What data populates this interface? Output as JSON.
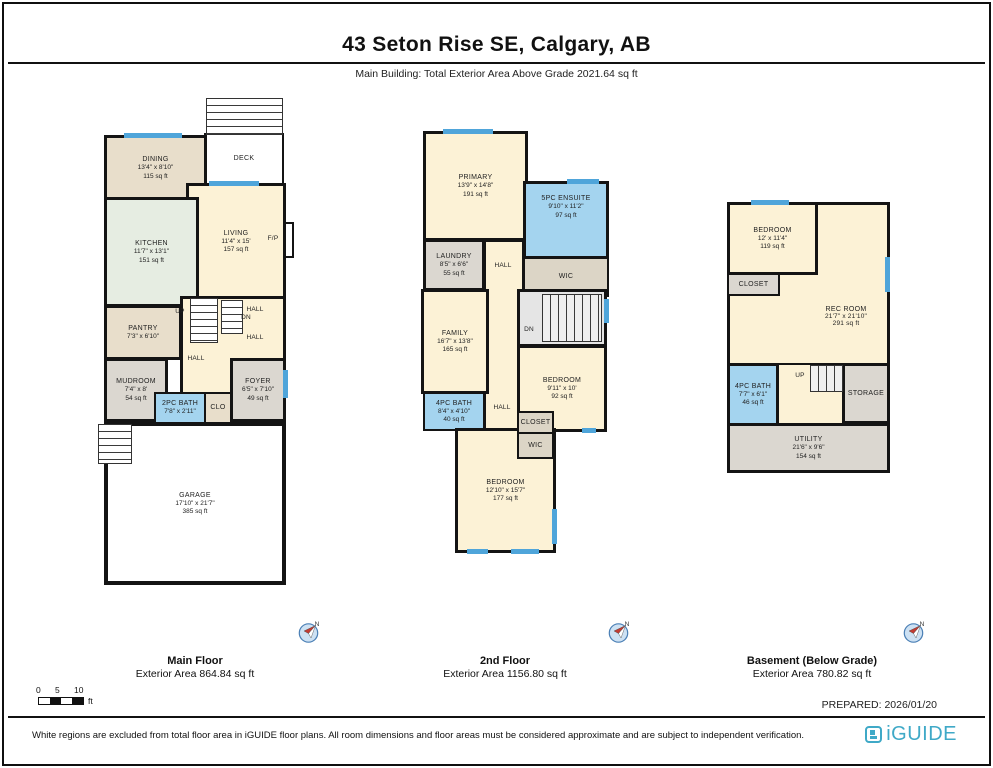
{
  "header": {
    "title": "43 Seton Rise SE, Calgary, AB",
    "subtitle": "Main Building: Total Exterior Area Above Grade 2021.64 sq ft"
  },
  "floors": [
    {
      "caption": "Main Floor",
      "area": "Exterior Area 864.84 sq ft",
      "rooms": {
        "deck": {
          "label": "DECK"
        },
        "dining": {
          "label": "DINING",
          "dims": "13'4\" x 8'10\"",
          "area": "115 sq ft"
        },
        "kitchen": {
          "label": "KITCHEN",
          "dims": "11'7\" x 13'1\"",
          "area": "151 sq ft"
        },
        "living": {
          "label": "LIVING",
          "dims": "11'4\" x 15'",
          "area": "157 sq ft"
        },
        "fp": {
          "label": "F/P"
        },
        "pantry": {
          "label": "PANTRY",
          "dims": "7'3\" x 6'10\""
        },
        "up": {
          "label": "UP"
        },
        "dn": {
          "label": "DN"
        },
        "hall_a": {
          "label": "HALL"
        },
        "hall_b": {
          "label": "HALL"
        },
        "hall": {
          "label": "HALL"
        },
        "mudroom": {
          "label": "MUDROOM",
          "dims": "7'4\" x 8'",
          "area": "54 sq ft"
        },
        "bath2": {
          "label": "2PC BATH",
          "dims": "7'8\" x 2'11\""
        },
        "clo": {
          "label": "CLO"
        },
        "foyer": {
          "label": "FOYER",
          "dims": "6'5\" x 7'10\"",
          "area": "49 sq ft"
        },
        "garage": {
          "label": "GARAGE",
          "dims": "17'10\" x 21'7\"",
          "area": "385 sq ft"
        }
      }
    },
    {
      "caption": "2nd Floor",
      "area": "Exterior Area 1156.80 sq ft",
      "rooms": {
        "primary": {
          "label": "PRIMARY",
          "dims": "13'9\" x 14'8\"",
          "area": "191 sq ft"
        },
        "ensuite": {
          "label": "5PC ENSUITE",
          "dims": "9'10\" x 11'2\"",
          "area": "97 sq ft"
        },
        "wic_top": {
          "label": "WIC"
        },
        "laundry": {
          "label": "LAUNDRY",
          "dims": "8'5\" x 6'6\"",
          "area": "55 sq ft"
        },
        "hall_upper": {
          "label": "HALL"
        },
        "family": {
          "label": "FAMILY",
          "dims": "16'7\" x 13'8\"",
          "area": "165 sq ft"
        },
        "dn": {
          "label": "DN"
        },
        "bedroom2": {
          "label": "BEDROOM",
          "dims": "9'11\" x 10'",
          "area": "92 sq ft"
        },
        "bath4": {
          "label": "4PC BATH",
          "dims": "8'4\" x 4'10\"",
          "area": "40 sq ft"
        },
        "hall_lower": {
          "label": "HALL"
        },
        "closet": {
          "label": "CLOSET"
        },
        "wic_bottom": {
          "label": "WIC"
        },
        "bedroom3": {
          "label": "BEDROOM",
          "dims": "12'10\" x 15'7\"",
          "area": "177 sq ft"
        }
      }
    },
    {
      "caption": "Basement (Below Grade)",
      "area": "Exterior Area 780.82 sq ft",
      "rooms": {
        "bedroom": {
          "label": "BEDROOM",
          "dims": "12' x 11'4\"",
          "area": "119 sq ft"
        },
        "closet": {
          "label": "CLOSET"
        },
        "recroom": {
          "label": "REC ROOM",
          "dims": "21'7\" x 21'10\"",
          "area": "291 sq ft"
        },
        "bath4": {
          "label": "4PC BATH",
          "dims": "7'7\" x 6'1\"",
          "area": "46 sq ft"
        },
        "up": {
          "label": "UP"
        },
        "storage": {
          "label": "STORAGE"
        },
        "utility": {
          "label": "UTILITY",
          "dims": "21'6\" x 9'6\"",
          "area": "154 sq ft"
        }
      }
    }
  ],
  "compass_n": "N",
  "scalebar": {
    "ticks": [
      "0",
      "5",
      "10"
    ],
    "unit": "ft"
  },
  "prepared": "PREPARED: 2026/01/20",
  "disclaimer": "White regions are excluded from total floor area in iGUIDE floor plans. All room dimensions and floor areas must be considered approximate and are subject to independent verification.",
  "brand": {
    "name": "iGUIDE"
  },
  "colors": {
    "room_cream": "#fcf2d6",
    "room_beige": "#e8decb",
    "room_mint": "#e6ede2",
    "room_blue": "#a4d4ef",
    "room_gray": "#dbd7d0",
    "room_tan": "#dcd5c6",
    "window_blue": "#4fa5da",
    "wall": "#141414",
    "brand_teal": "#3fa9c7"
  }
}
